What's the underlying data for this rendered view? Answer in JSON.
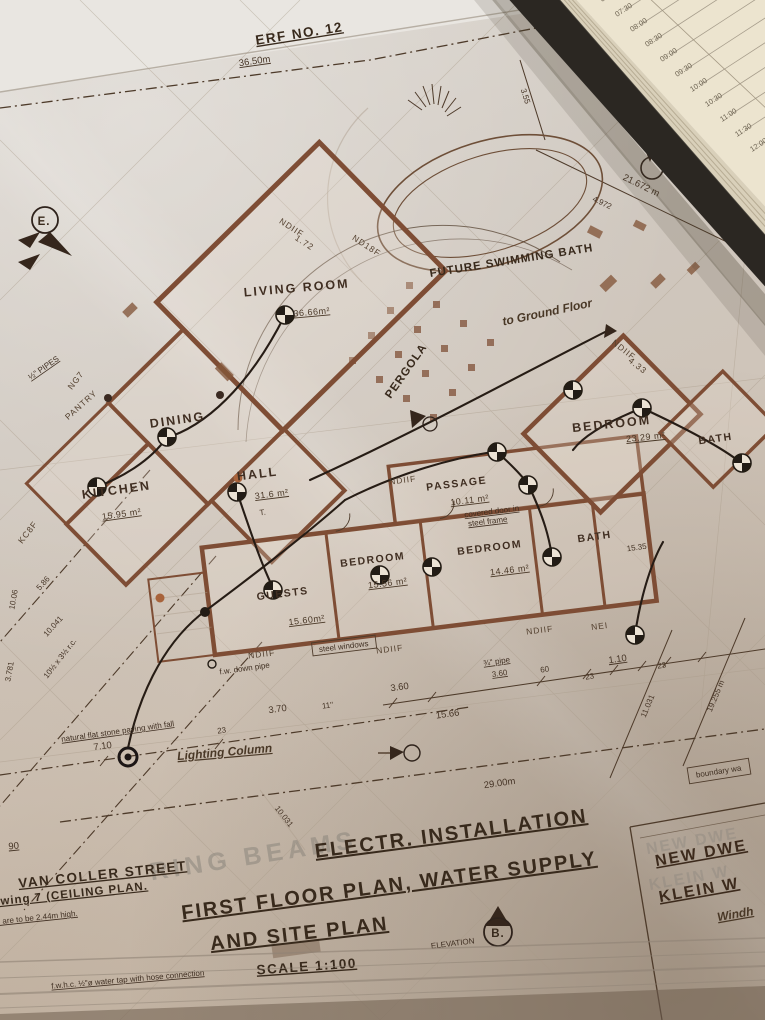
{
  "book": {
    "times": [
      "07:00",
      "07:30",
      "08:00",
      "08:30",
      "09:00",
      "09:30",
      "10:00",
      "10:30",
      "11:00",
      "11:30",
      "12:00",
      "12:30"
    ]
  },
  "plan": {
    "erf": "ERF NO. 12",
    "markers": {
      "e": "E.",
      "b": "B.",
      "elevation": "ELEVATION"
    },
    "pool": "FUTURE SWIMMING BATH",
    "pergola": "PERGOLA",
    "ground_floor": "to Ground Floor",
    "rooms": {
      "living": {
        "label": "LIVING ROOM",
        "area": "36.66m²"
      },
      "dining": {
        "label": "DINING"
      },
      "kitchen": {
        "label": "KITCHEN",
        "area": "15.95 m²"
      },
      "pantry": {
        "label": "PANTRY"
      },
      "hall": {
        "label": "HALL",
        "area": "31.6 m²"
      },
      "guests": {
        "label": "GUESTS",
        "area": "15.60m²"
      },
      "bedroom1": {
        "label": "BEDROOM",
        "area": "15.56 m²"
      },
      "bedroom2": {
        "label": "BEDROOM",
        "area": "14.46 m²"
      },
      "bedroom3": {
        "label": "BEDROOM",
        "area": "23.29 m²"
      },
      "passage": {
        "label": "PASSAGE",
        "area": "10.11 m²"
      },
      "bath1": {
        "label": "BATH"
      },
      "bath2": {
        "label": "BATH"
      }
    },
    "codes": {
      "ndiif_a": "NDIIF",
      "r172": "1.72",
      "nd18f": "ND18F",
      "ndiif_b": "NDIIF",
      "r433": "4.33",
      "ndiif_c": "NDIIF",
      "ndiif_d": "NDIIF",
      "ndiif_e": "NDIIF",
      "ndiif_f": "NDIIF",
      "nei": "NEI",
      "ng7": "NG7",
      "kc8f": "KC8F"
    },
    "dims": {
      "site_front": "36.50m",
      "site_right": "21.672 m",
      "d4972": "4.972",
      "d355": "3.55",
      "d29": "29.00m",
      "d1566": "15.66",
      "d370": "3.70",
      "d360a": "3.60",
      "d360b": "3.60",
      "d60": "60",
      "d110": "1.10",
      "d23a": "23",
      "d23b": "23",
      "d23c": "23",
      "d11in": "11''",
      "d710": "7.10",
      "d586": "5.86",
      "d10041": "10.041",
      "d11031": "11.031",
      "d19255": "19.255 m",
      "d10031": "10.031",
      "d3781": "3.781",
      "d1006": "10.06",
      "d90": "90",
      "d1535": "15.35"
    },
    "notes": {
      "pipes": "½\" PIPES",
      "pipe34": "¾\" pipe",
      "steel": "steel windows",
      "downpipe": "f.w. down pipe",
      "door1": "covered door in",
      "door2": "steel frame",
      "paving": "natural flat stone paving with fall",
      "lighting": "Lighting Column",
      "boundary": "boundary wa",
      "height": "8 are to be 2.44m high.",
      "rc": "10½ x 3½ r.c.",
      "tsym": "T."
    },
    "titles": {
      "t1": "ELECTR. INSTALLATION",
      "t2": "FIRST FLOOR PLAN, WATER SUPPLY",
      "t3": "AND SITE PLAN",
      "scale": "SCALE 1:100",
      "street": "VAN COLLER STREET",
      "ceiling": "rawing 7 (CEILING PLAN.",
      "tap": "f.w.h.c. ½\"ø water tap with hose connection",
      "ghost": "RING BEAMS"
    },
    "block": {
      "l1": "NEW DWE",
      "l2": "KLEIN W",
      "l3": "Windh"
    }
  }
}
